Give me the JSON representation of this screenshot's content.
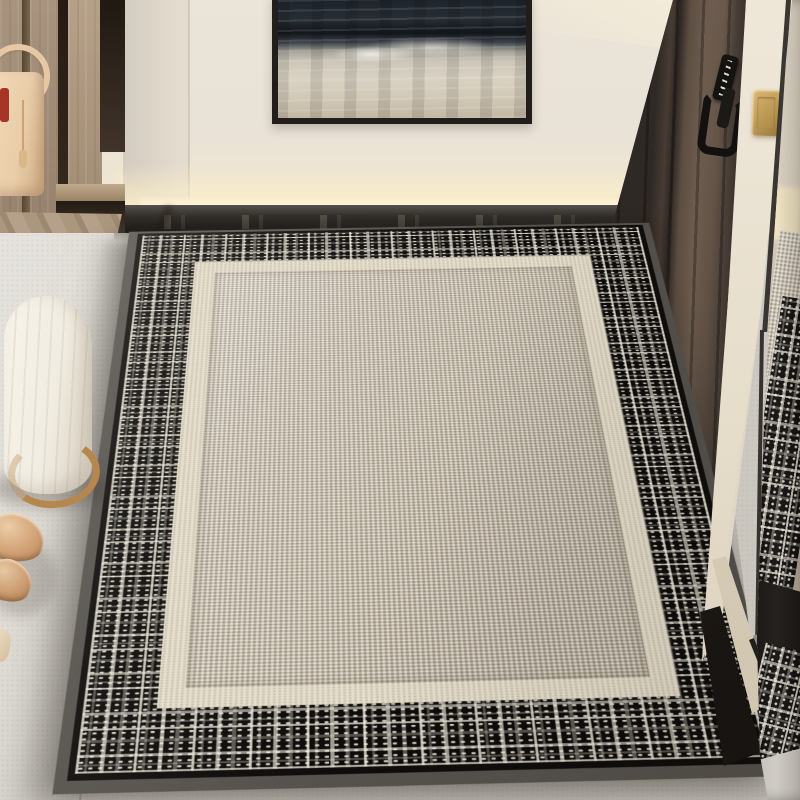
{
  "meta": {
    "type": "interior-product-photo",
    "subject": "Checkered tweed entryway door mat in a hallway with wardrobe, mirror and front door",
    "width_px": 800,
    "height_px": 800
  },
  "palette": {
    "wall": "#eae3d7",
    "wall-shade": "#d5cec2",
    "glow": "#f8ebc6",
    "baseboard": "#2b2825",
    "floor": "#d8d4cc",
    "wood": "#a18b73",
    "wood-dark": "#6e5c4c",
    "frame": "#201d1a",
    "rug-black": "#0d0c0a",
    "rug-white": "#eee8db",
    "rug-cream": "#e5decc",
    "rug-field": "#c8bfb0",
    "rug-edge": "#55524e",
    "door": "#4a4038",
    "door-panel": "#6a594d",
    "handle": "#121110",
    "switch-gold": "#c3a05c",
    "mirror-frame": "#8d8984",
    "bag": "#ecd0ae",
    "bag-red": "#a63527",
    "bag-gold": "#d9b888",
    "pouf": "#f3efe6",
    "pouf-wood": "#b6874d",
    "shoe": "#cfa075"
  },
  "scene": {
    "lighting": {
      "led_cove": "warm LED strip glow along bottom of wall above baseboard",
      "glow_color": "#f8ebc6"
    },
    "wall": {
      "color": "#eae3d7",
      "baseboard": "dark glossy baseboard with faint reflections of the rug"
    },
    "artwork": {
      "kind": "abstract seascape painting, cropped at top edge",
      "frame_color": "#201d1a",
      "sea_color": "#22262c",
      "foam_color": "#d5cdbd"
    },
    "wardrobe": {
      "kind": "light oak entry cabinet with open shelf and dark recesses",
      "wood_color": "#a18b73"
    },
    "handbag": {
      "color": "#ecd0ae",
      "details": [
        "red accent",
        "gold tassel",
        "round handle"
      ]
    },
    "stool": {
      "kind": "round channel-tufted pouf",
      "fabric_color": "#f3efe6",
      "base": "wood ring #b6874d"
    },
    "shoes": {
      "kind": "pair of nude pointed flats near lower-left edge",
      "color": "#cfa075"
    },
    "rug": {
      "kind": "rectangular low-pile entry mat seen in perspective",
      "outer_edge": "grey rubber binding #55524e",
      "border": "black and ivory tweed plaid",
      "inner_border": "cream boucle band #e5decc",
      "field": "greige boucle weave #c8bfb0"
    },
    "door": {
      "color": "dark walnut #4a4038",
      "hardware": [
        "black lever handle",
        "black smart-lock keypad"
      ]
    },
    "light_switch": {
      "color": "brass #c3a05c"
    },
    "mirror": {
      "kind": "full-height mirror at right edge reflecting the rug, wall glow and floor",
      "frame_color": "#8d8984"
    },
    "floor": {
      "kind": "large light-grey porcelain tiles",
      "color": "#d8d4cc"
    }
  }
}
